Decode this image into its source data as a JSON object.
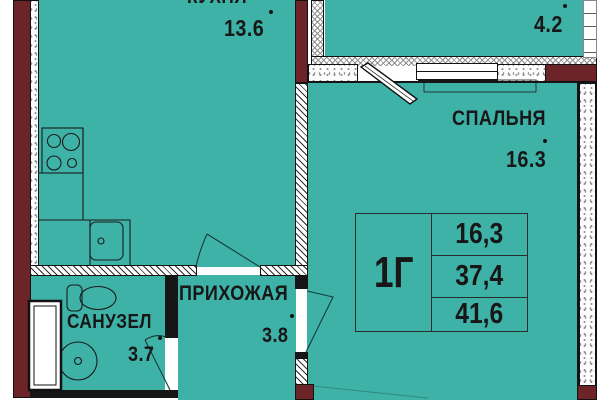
{
  "plan": {
    "rooms": {
      "kitchen": {
        "label": "КУХНЯ",
        "area": "13.6"
      },
      "loggia": {
        "area": "4.2"
      },
      "bedroom": {
        "label": "СПАЛЬНЯ",
        "area": "16.3"
      },
      "hallway": {
        "label": "ПРИХОЖАЯ",
        "area": "3.8"
      },
      "bathroom": {
        "label": "САНУЗЕЛ",
        "area": "3.7"
      }
    },
    "info_table": {
      "unit_type": "1Г",
      "rows": [
        "16,3",
        "37,4",
        "41,6"
      ]
    },
    "colors": {
      "floor": "#3fb2a8",
      "brick": "#6d2429",
      "wall_dark": "#161616"
    }
  }
}
